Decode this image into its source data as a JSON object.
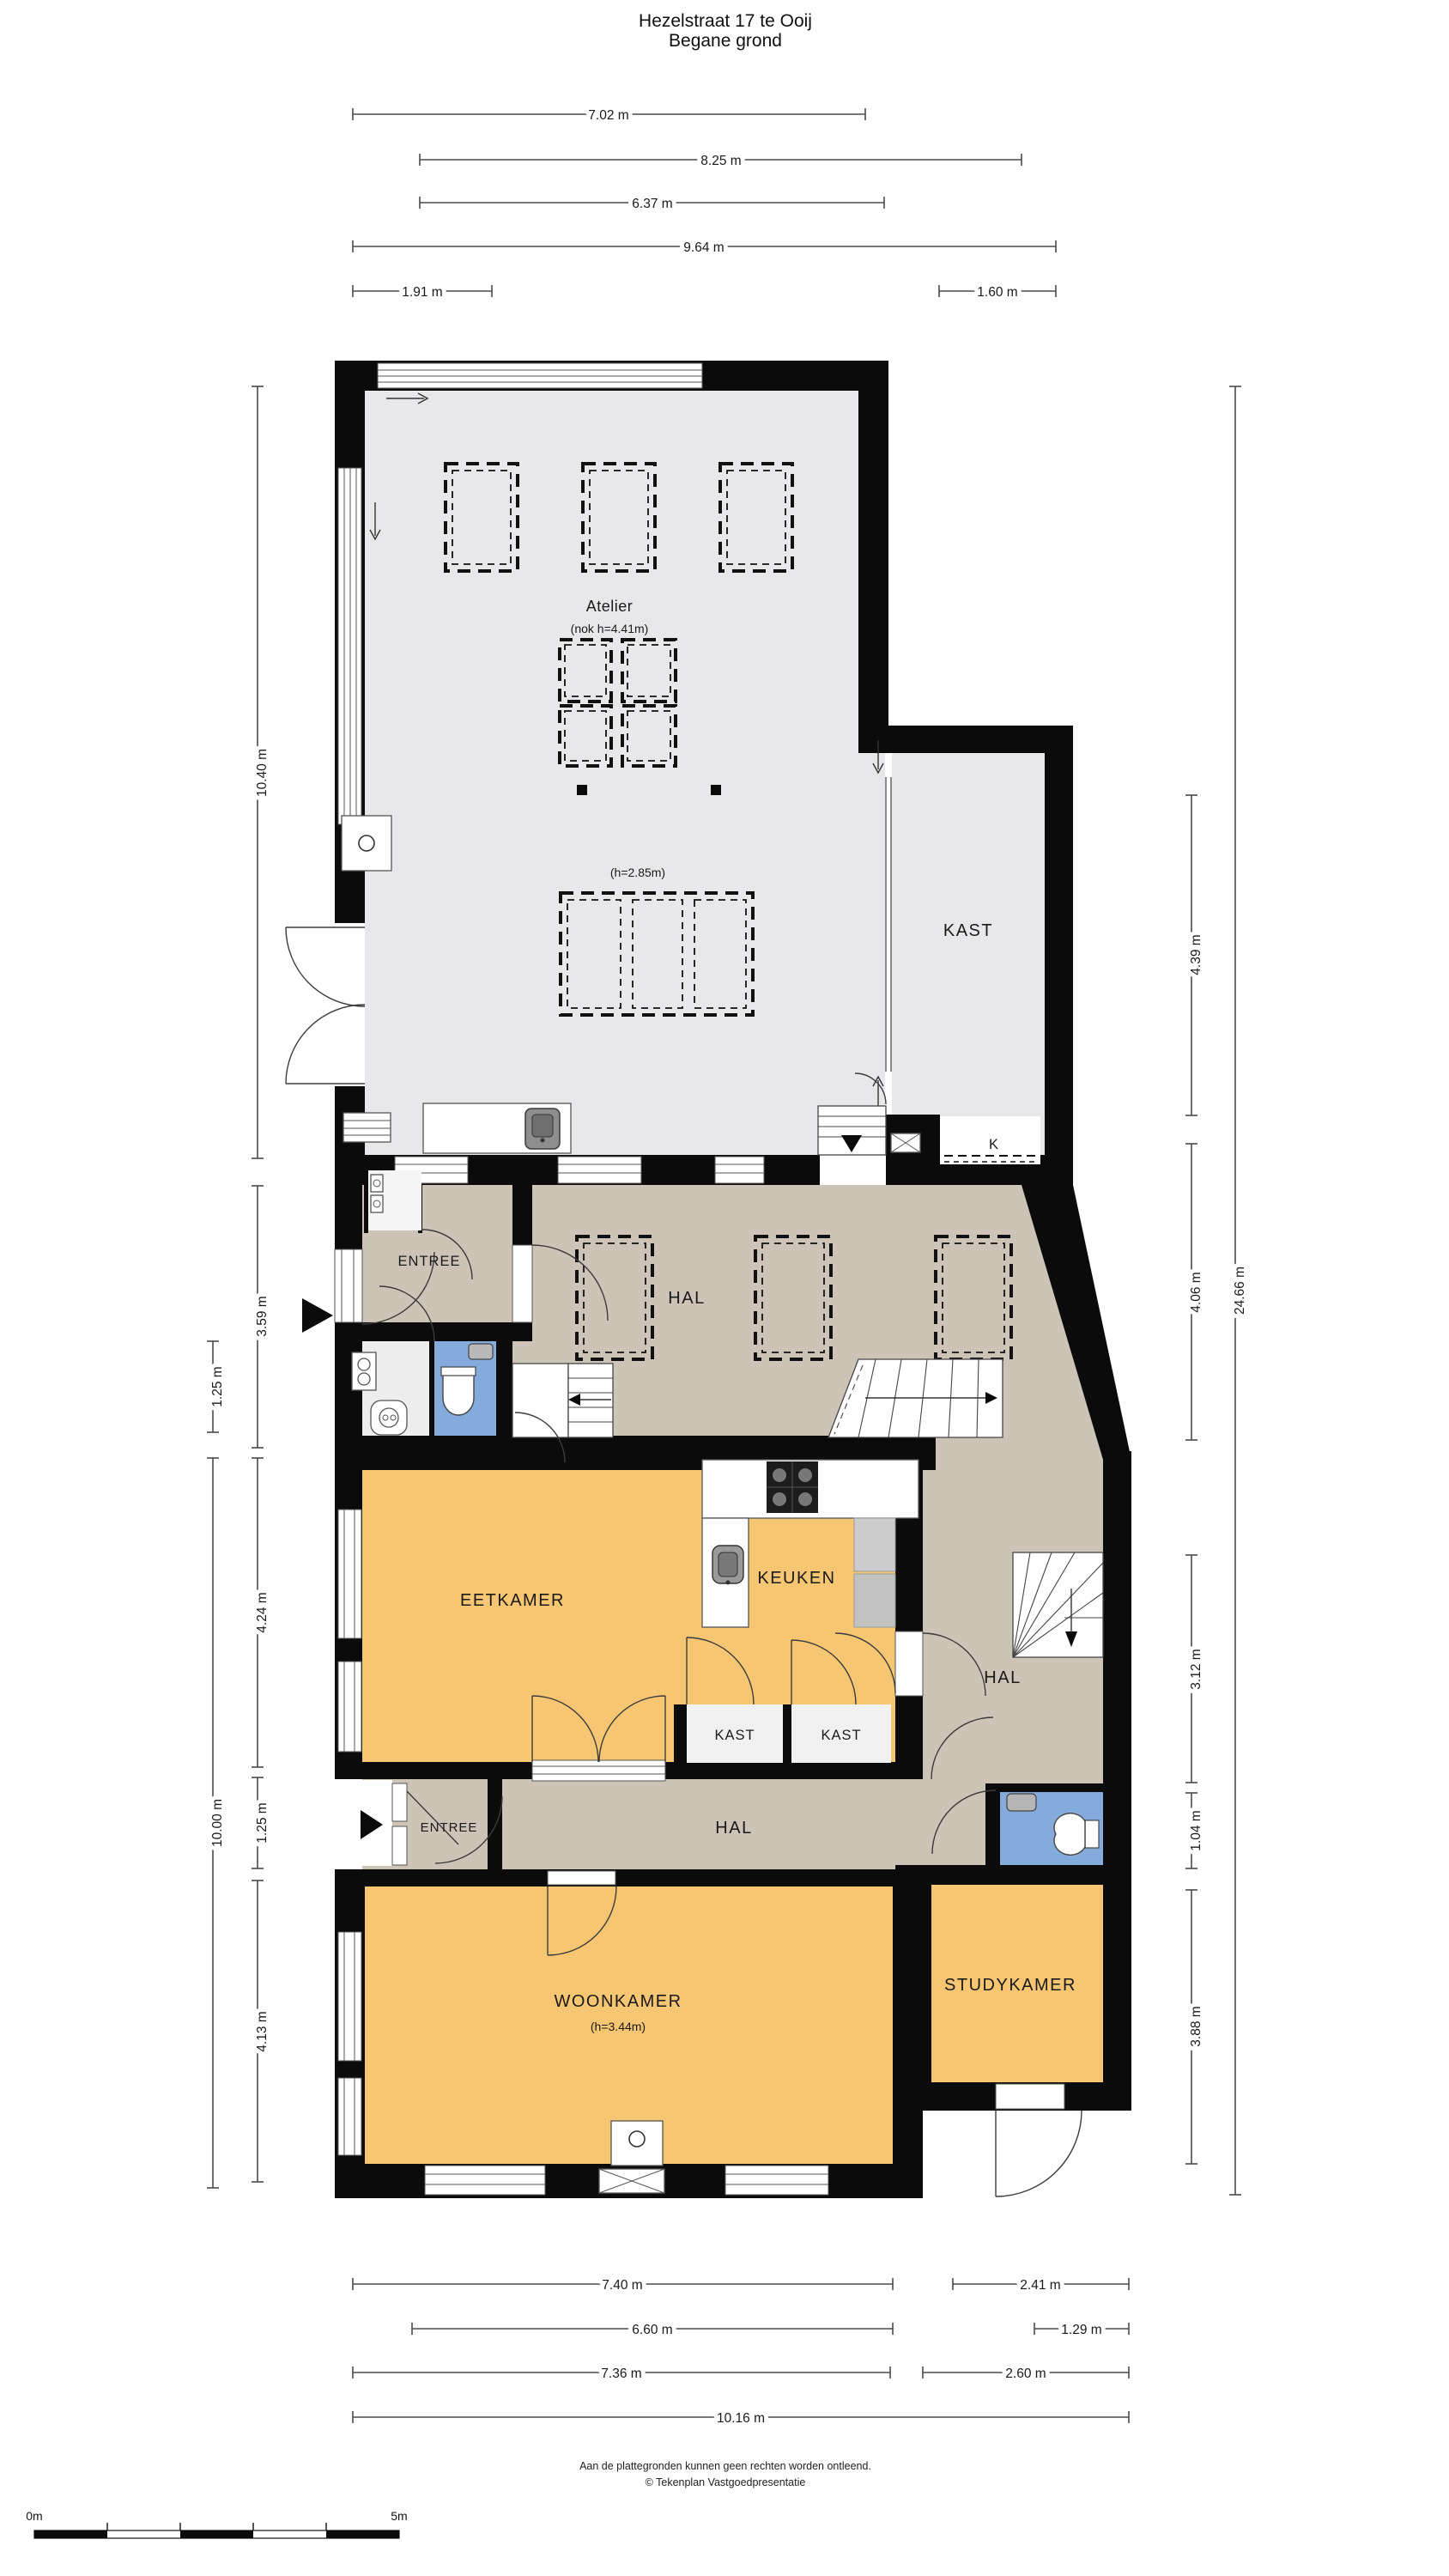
{
  "title": {
    "line1": "Hezelstraat 17 te Ooij",
    "line2": "Begane grond"
  },
  "rooms": {
    "atelier": "Atelier",
    "atelier_nok": "(nok h=4.41m)",
    "atelier_h": "(h=2.85m)",
    "kast_top": "KAST",
    "entree1": "ENTREE",
    "hal_mid": "HAL",
    "eetkamer": "EETKAMER",
    "keuken": "KEUKEN",
    "kast1": "KAST",
    "kast2": "KAST",
    "hal_right": "HAL",
    "hal2": "HAL",
    "entree2": "ENTREE",
    "woonkamer": "WOONKAMER",
    "woonkamer_h": "(h=3.44m)",
    "studykamer": "STUDYKAMER",
    "k_label": "K"
  },
  "dimensions": {
    "top": [
      "7.02 m",
      "8.25 m",
      "6.37 m",
      "9.64 m",
      "1.91 m",
      "1.60 m"
    ],
    "left": [
      "10.40 m",
      "3.59 m",
      "1.25 m",
      "10.00 m",
      "4.24 m",
      "1.25 m",
      "4.13 m"
    ],
    "right": [
      "4.39 m",
      "4.06 m",
      "3.12 m",
      "1.04 m",
      "3.88 m",
      "24.66 m"
    ],
    "bottom": [
      "7.40 m",
      "2.41 m",
      "6.60 m",
      "1.29 m",
      "7.36 m",
      "2.60 m",
      "10.16 m"
    ]
  },
  "scalebar": {
    "start_label": "0m",
    "end_label": "5m"
  },
  "footer": {
    "line1": "Aan de plattegronden kunnen geen rechten worden ontleend.",
    "line2": "© Tekenplan Vastgoedpresentatie"
  },
  "colors": {
    "wall": "#0b0b0b",
    "floor_gray": "#e8e8ea",
    "floor_tan": "#cdc3b6",
    "floor_orange": "#f7c672",
    "floor_blue": "#85abdd",
    "dimension": "#4a4a4a"
  }
}
